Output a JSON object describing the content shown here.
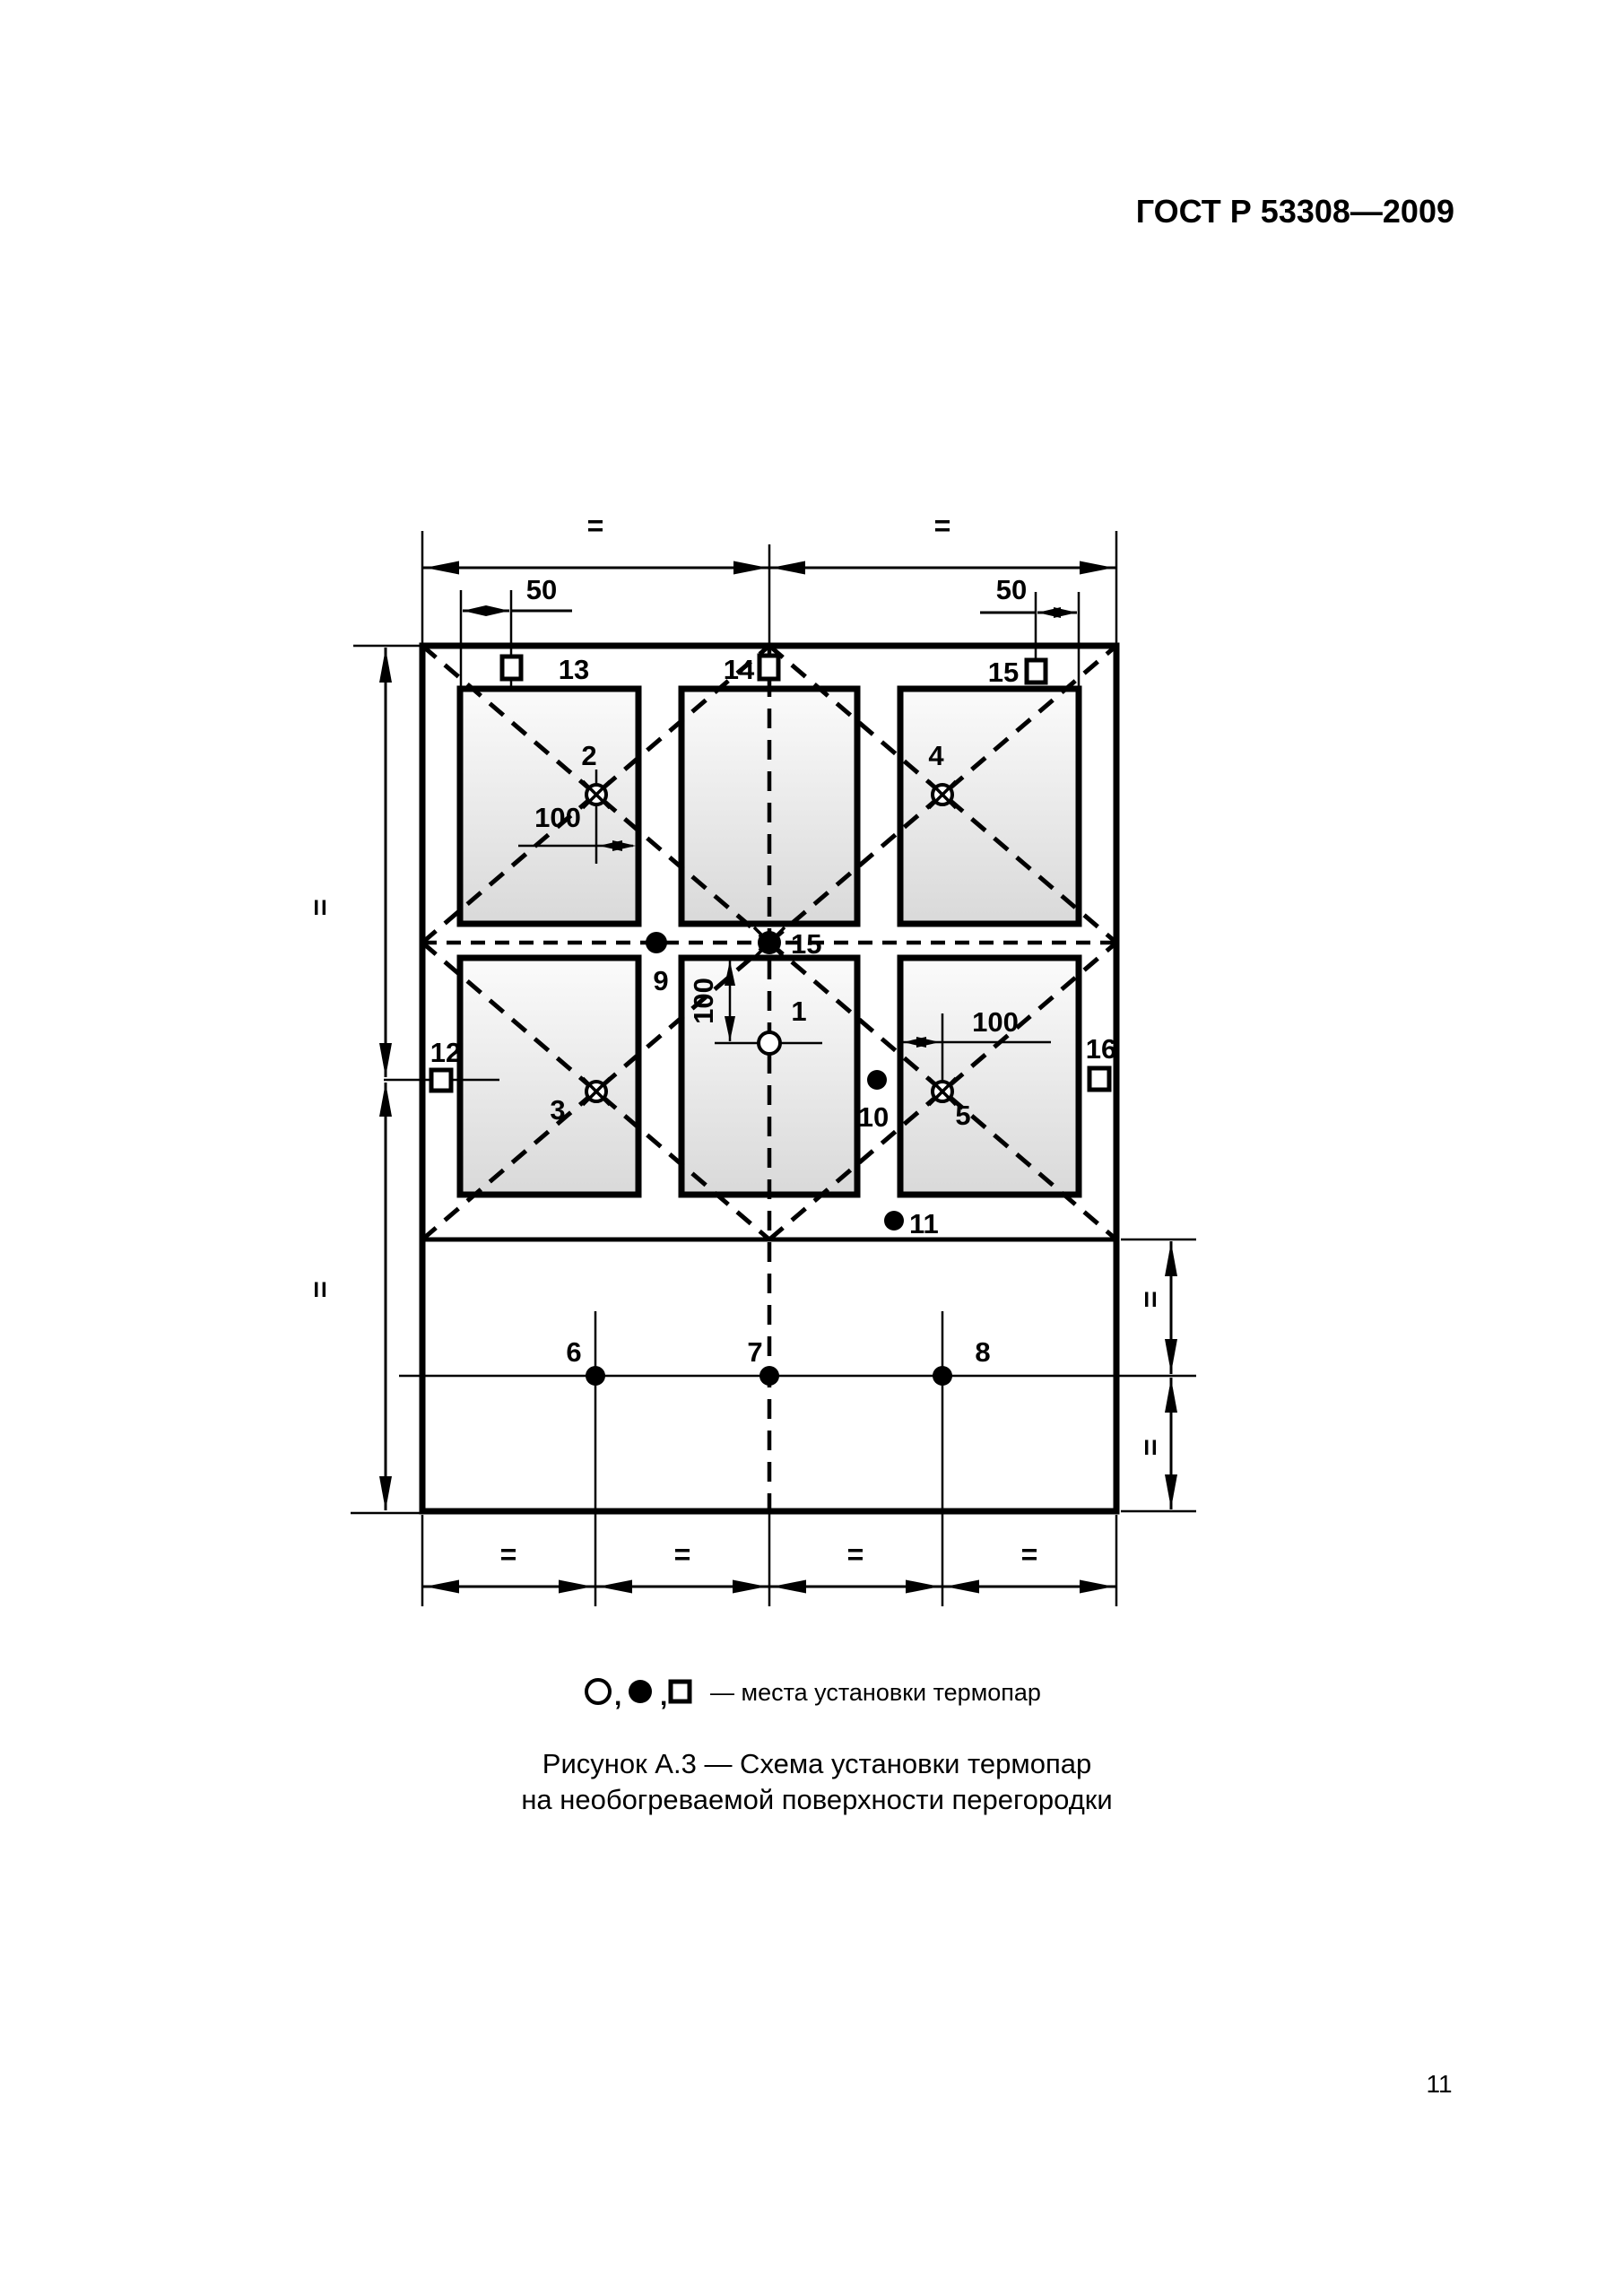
{
  "header": {
    "title": "ГОСТ Р 53308—2009"
  },
  "page": {
    "number": "11"
  },
  "dims": {
    "eq": "=",
    "ii": "II",
    "d50": "50",
    "d100": "100"
  },
  "points": {
    "p1": "1",
    "p2": "2",
    "p3": "3",
    "p4": "4",
    "p5": "5",
    "p6": "6",
    "p7": "7",
    "p8": "8",
    "p9": "9",
    "p10": "10",
    "p11": "11",
    "p12": "12",
    "p13": "13",
    "p14": "14",
    "p15": "15",
    "p16": "16"
  },
  "legend": {
    "symbols": [
      "open-circle-icon",
      "filled-circle-icon",
      "open-square-icon"
    ],
    "separator": ",",
    "text": "— места установки термопар"
  },
  "caption": {
    "line1": "Рисунок А.3 — Схема установки термопар",
    "line2": "на необогреваемой поверхности перегородки"
  }
}
